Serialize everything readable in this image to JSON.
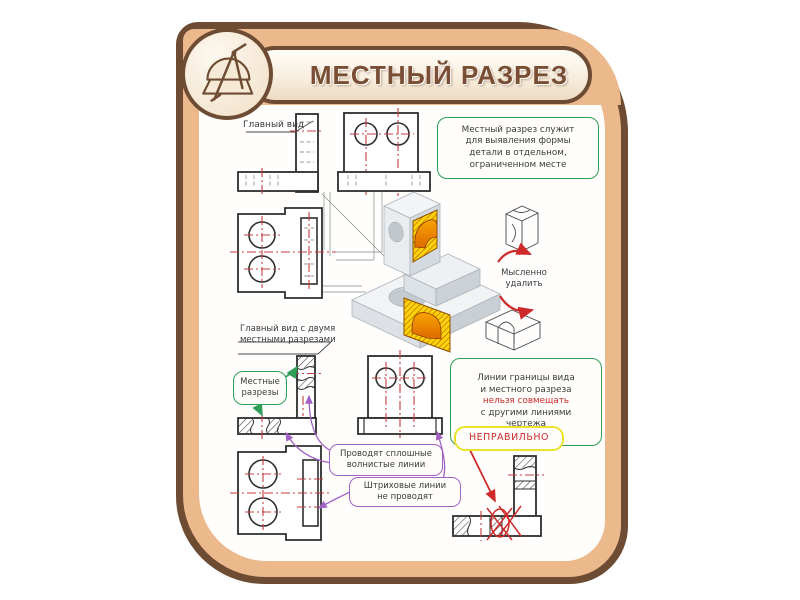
{
  "header": {
    "title": "МЕСТНЫЙ РАЗРЕЗ"
  },
  "labels": {
    "main_view": "Главный вид",
    "main_view_two_cuts": "Главный вид с двумя\nместными разрезами",
    "local_cuts": "Местные\nразрезы",
    "mentally_remove": "Мысленно\nудалить",
    "incorrect": "НЕПРАВИЛЬНО"
  },
  "callouts": {
    "definition": "Местный разрез служит\nдля выявления формы\nдетали в отдельном,\nограниченном месте",
    "wavy_lines": "Проводят сплошные\nволнистые линии",
    "no_dashed_lines": "Штриховые линии\nне проводят",
    "rule_top": "Линии границы вида\nи местного разреза",
    "rule_red": "нельзя совмещать",
    "rule_bottom": "с другими линиями\nчертежа"
  },
  "colors": {
    "frame_brown": "#6e4b33",
    "band_tan": "#ecb98d",
    "accent_green": "#2f9e57",
    "accent_purple": "#a263c4",
    "accent_red": "#ce2a2a",
    "warning_yellow_border": "#ece22c",
    "section_yellow": "#ffd30a",
    "section_orange": "#ef8a00",
    "centerline_red": "#c53b3c"
  }
}
